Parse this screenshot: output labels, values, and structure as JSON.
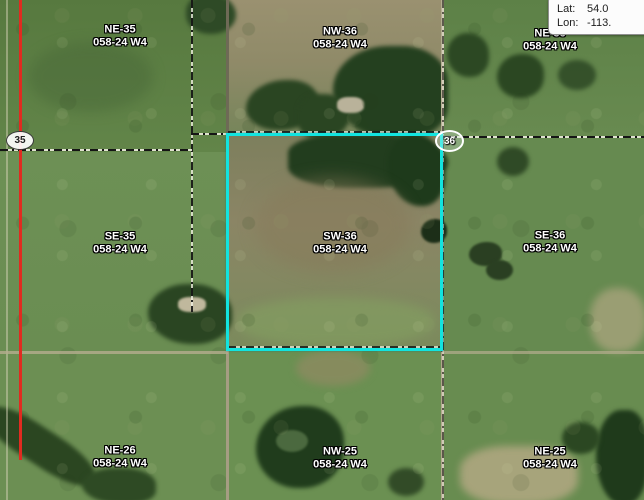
{
  "info_box": {
    "lat_label": "Lat:",
    "lat_value": "54.0",
    "lon_label": "Lon:",
    "lon_value": "-113."
  },
  "map": {
    "sections": [
      {
        "id": "ne35",
        "quarter": "NE-35",
        "township": "058-24 W4"
      },
      {
        "id": "nw36",
        "quarter": "NW-36",
        "township": "058-24 W4"
      },
      {
        "id": "ne36",
        "quarter": "NE-36",
        "township": "058-24 W4"
      },
      {
        "id": "se35",
        "quarter": "SE-35",
        "township": "058-24 W4"
      },
      {
        "id": "sw36",
        "quarter": "SW-36",
        "township": "058-24 W4",
        "selected": true
      },
      {
        "id": "se36",
        "quarter": "SE-36",
        "township": "058-24 W4"
      },
      {
        "id": "ne26",
        "quarter": "NE-26",
        "township": "058-24 W4"
      },
      {
        "id": "nw25",
        "quarter": "NW-25",
        "township": "058-24 W4"
      },
      {
        "id": "ne25",
        "quarter": "NE-25",
        "township": "058-24 W4"
      }
    ],
    "road_markers": [
      {
        "label": "35"
      },
      {
        "label": "36"
      }
    ],
    "colors": {
      "selection_outline": "#12e4df",
      "highlighted_road": "#e02b20",
      "label_text": "#ffffff"
    }
  }
}
